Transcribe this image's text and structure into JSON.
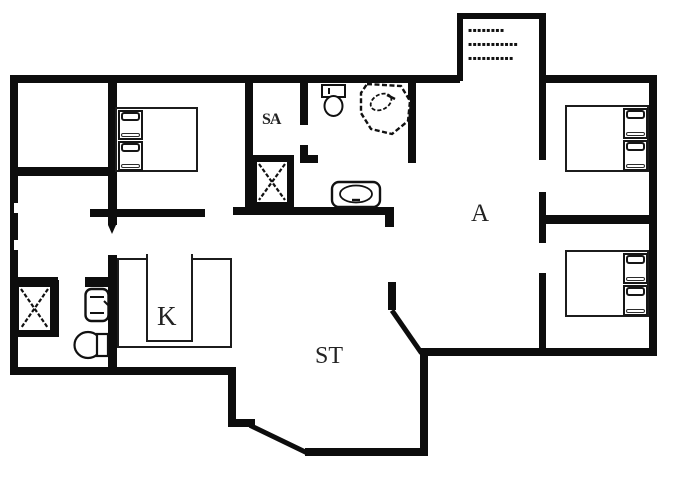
{
  "document": {
    "type": "holiday-house floor plan"
  },
  "colors": {
    "wall": "#0d0d0d",
    "line": "#1c1c1c",
    "background": "#ffffff"
  },
  "labels": {
    "sauna": "SA",
    "kitchen": "K",
    "living_room": "ST",
    "room_a": "A"
  },
  "porch_note": {
    "line1": "▪▪▪▪▪▪▪▪",
    "line2": "▪▪▪▪▪▪▪▪▪▪▪",
    "line3": "▪▪▪▪▪▪▪▪▪▪"
  },
  "fixtures": {
    "double_beds": 3,
    "showers": 2,
    "toilets": 2,
    "washbasins": 2,
    "corner_bath": 1,
    "kitchen_counter": 1
  }
}
